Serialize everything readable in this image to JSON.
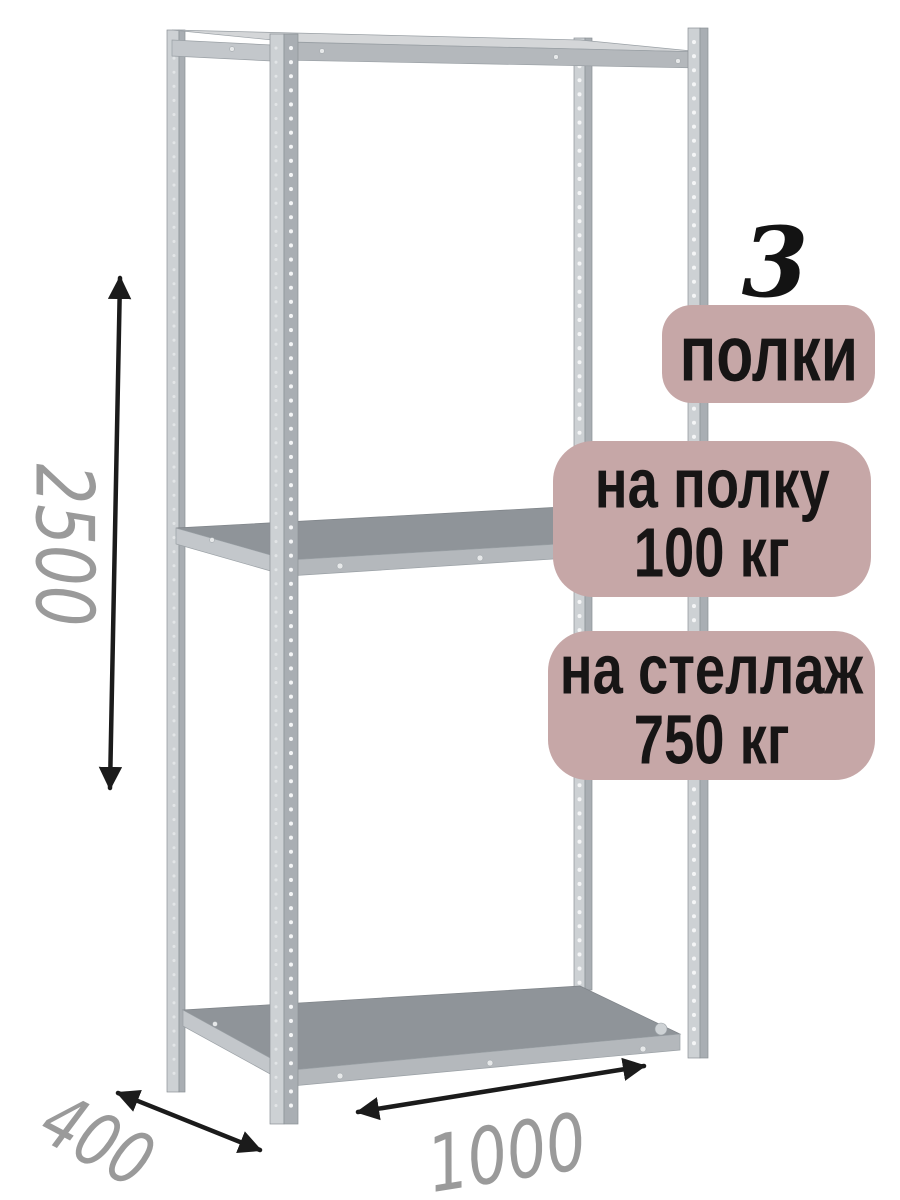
{
  "annotations": {
    "shelf_count": {
      "number": "3",
      "label": "полки"
    },
    "capacity_per_shelf": {
      "line1": "на полку",
      "line2": "100 кг"
    },
    "capacity_per_rack": {
      "line1": "на стеллаж",
      "line2": "750 кг"
    }
  },
  "dimensions": {
    "height": "2500",
    "depth": "400",
    "width": "1000"
  },
  "colors": {
    "page_bg": "#ffffff",
    "badge_bg": "#c6a7a7",
    "badge_text": "#171515",
    "count_text": "#131313",
    "dim_text": "#9a9a9a",
    "arrow": "#1b1b1b",
    "metal_light": "#d4d6d8",
    "metal_mid": "#b4b8bc",
    "metal_side": "#c3c7cb",
    "post_light": "#cdd1d4",
    "post_dark": "#a9aeb3",
    "shelf_surface": "#8f9499"
  }
}
